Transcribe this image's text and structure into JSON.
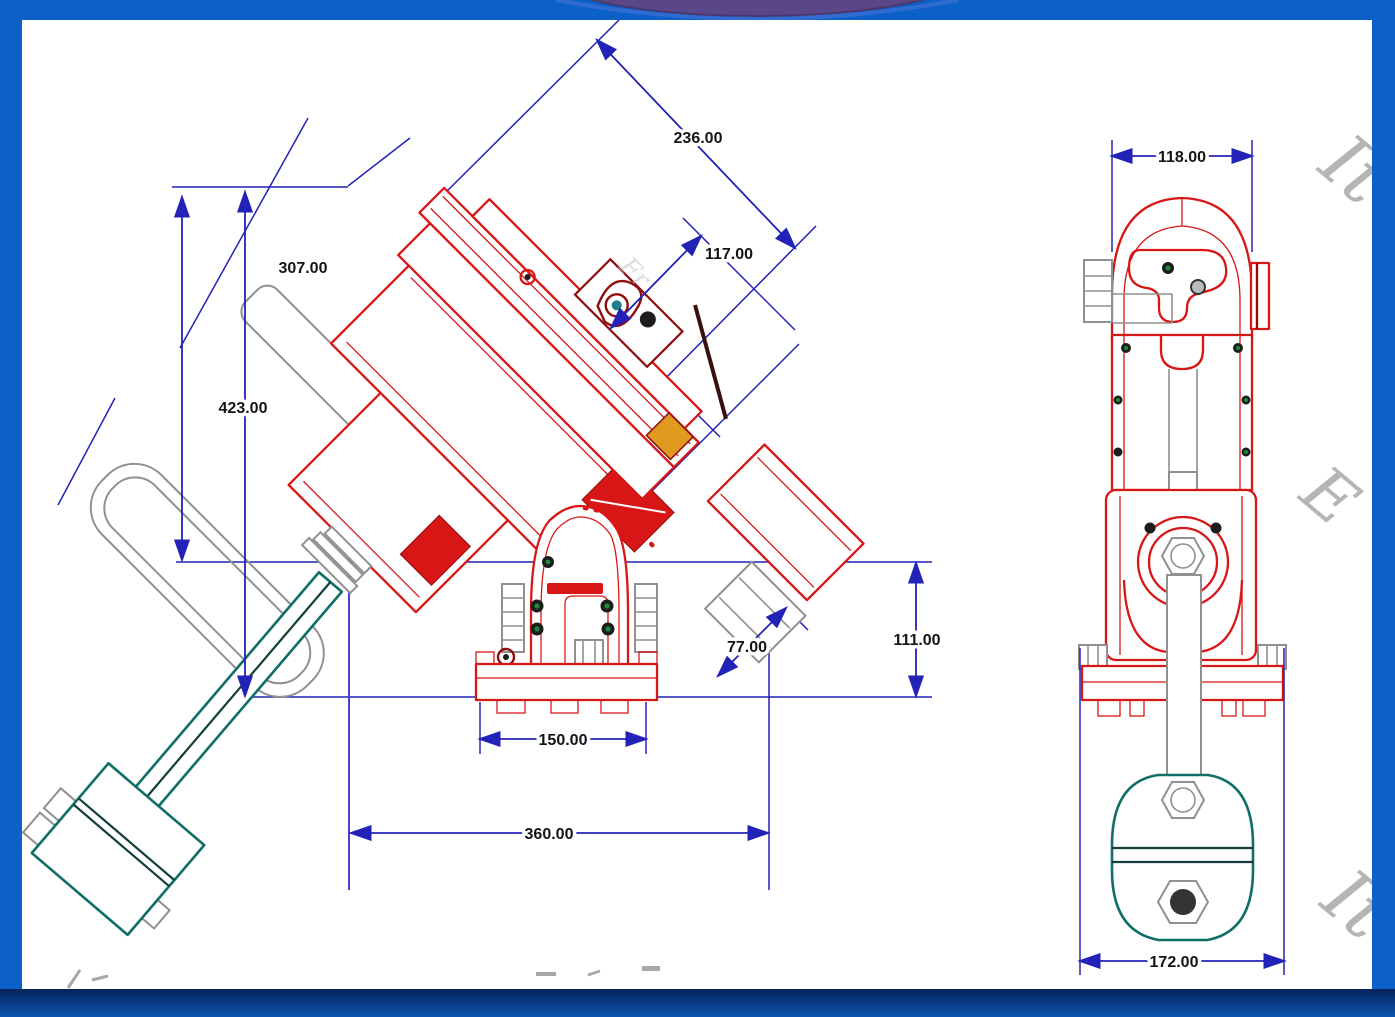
{
  "subject": "2D CAD dimensioned drawing of a German equatorial telescope mount with counterweight, side view and front view, on a white sheet inside a blue frame",
  "colors": {
    "frame_blue": "#0b61c7",
    "frame_navy": "#05235a",
    "frame_bottom_light": "#0f55b2",
    "canvas_white": "#ffffff",
    "ellipse_purple": "#5a4788",
    "ellipse_rim_blue": "#2f6bd0",
    "dim_blue": "#2222b8",
    "dim_violet": "#4b3fd6",
    "part_red": "#d81616",
    "part_dark_red": "#8f0d0d",
    "teal": "#0f6f66",
    "teal_dark": "#123f3b",
    "ghost_gray": "#909090",
    "watermark_gray": "#b5b5b5",
    "text_black": "#141414",
    "detail_green": "#1c8c3c",
    "detail_orange": "#e09a1e"
  },
  "views": {
    "side_view": {
      "title": "side view with counterweight",
      "dims": {
        "d236": "236.00",
        "d117": "117.00",
        "d307": "307.00",
        "d423": "423.00",
        "d77": "77.00",
        "d111": "111.00",
        "d150": "150.00",
        "d360": "360.00"
      }
    },
    "front_view": {
      "title": "front view",
      "dims": {
        "d118": "118.00",
        "d172": "172.00"
      }
    }
  },
  "watermarks": {
    "right_top": "It",
    "right_mid": "E",
    "right_bottom": "It",
    "saddle": "Fr"
  }
}
